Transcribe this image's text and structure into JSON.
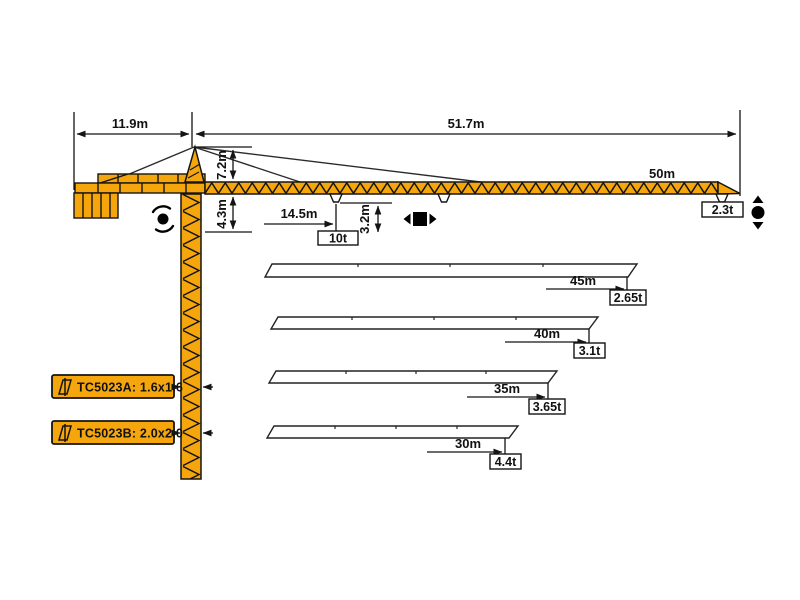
{
  "main_view": {
    "counter_jib_length": "11.9m",
    "working_range": "51.7m",
    "tower_head_height": "7.2m",
    "jib_underside_offset": "4.3m",
    "max_load_radius": "14.5m",
    "hook_clearance": "3.2m",
    "jib_length_label": "50m",
    "max_load": "10t",
    "tip_load": "2.3t"
  },
  "jib_variants": [
    {
      "length": "45m",
      "tip_load": "2.65t"
    },
    {
      "length": "40m",
      "tip_load": "3.1t"
    },
    {
      "length": "35m",
      "tip_load": "3.65t"
    },
    {
      "length": "30m",
      "tip_load": "4.4t"
    }
  ],
  "models": [
    {
      "label": "TC5023A: 1.6x1.6"
    },
    {
      "label": "TC5023B: 2.0x2.0"
    }
  ],
  "icons": {
    "slewing": "slewing-rotation-icon",
    "trolley": "trolley-travel-icon",
    "hoist": "hook-hoist-icon",
    "mast_section": "mast-section-icon"
  },
  "colors": {
    "crane_orange": "#F6A60D",
    "outline": "#141414",
    "label_box_bg": "#F6A60D"
  }
}
